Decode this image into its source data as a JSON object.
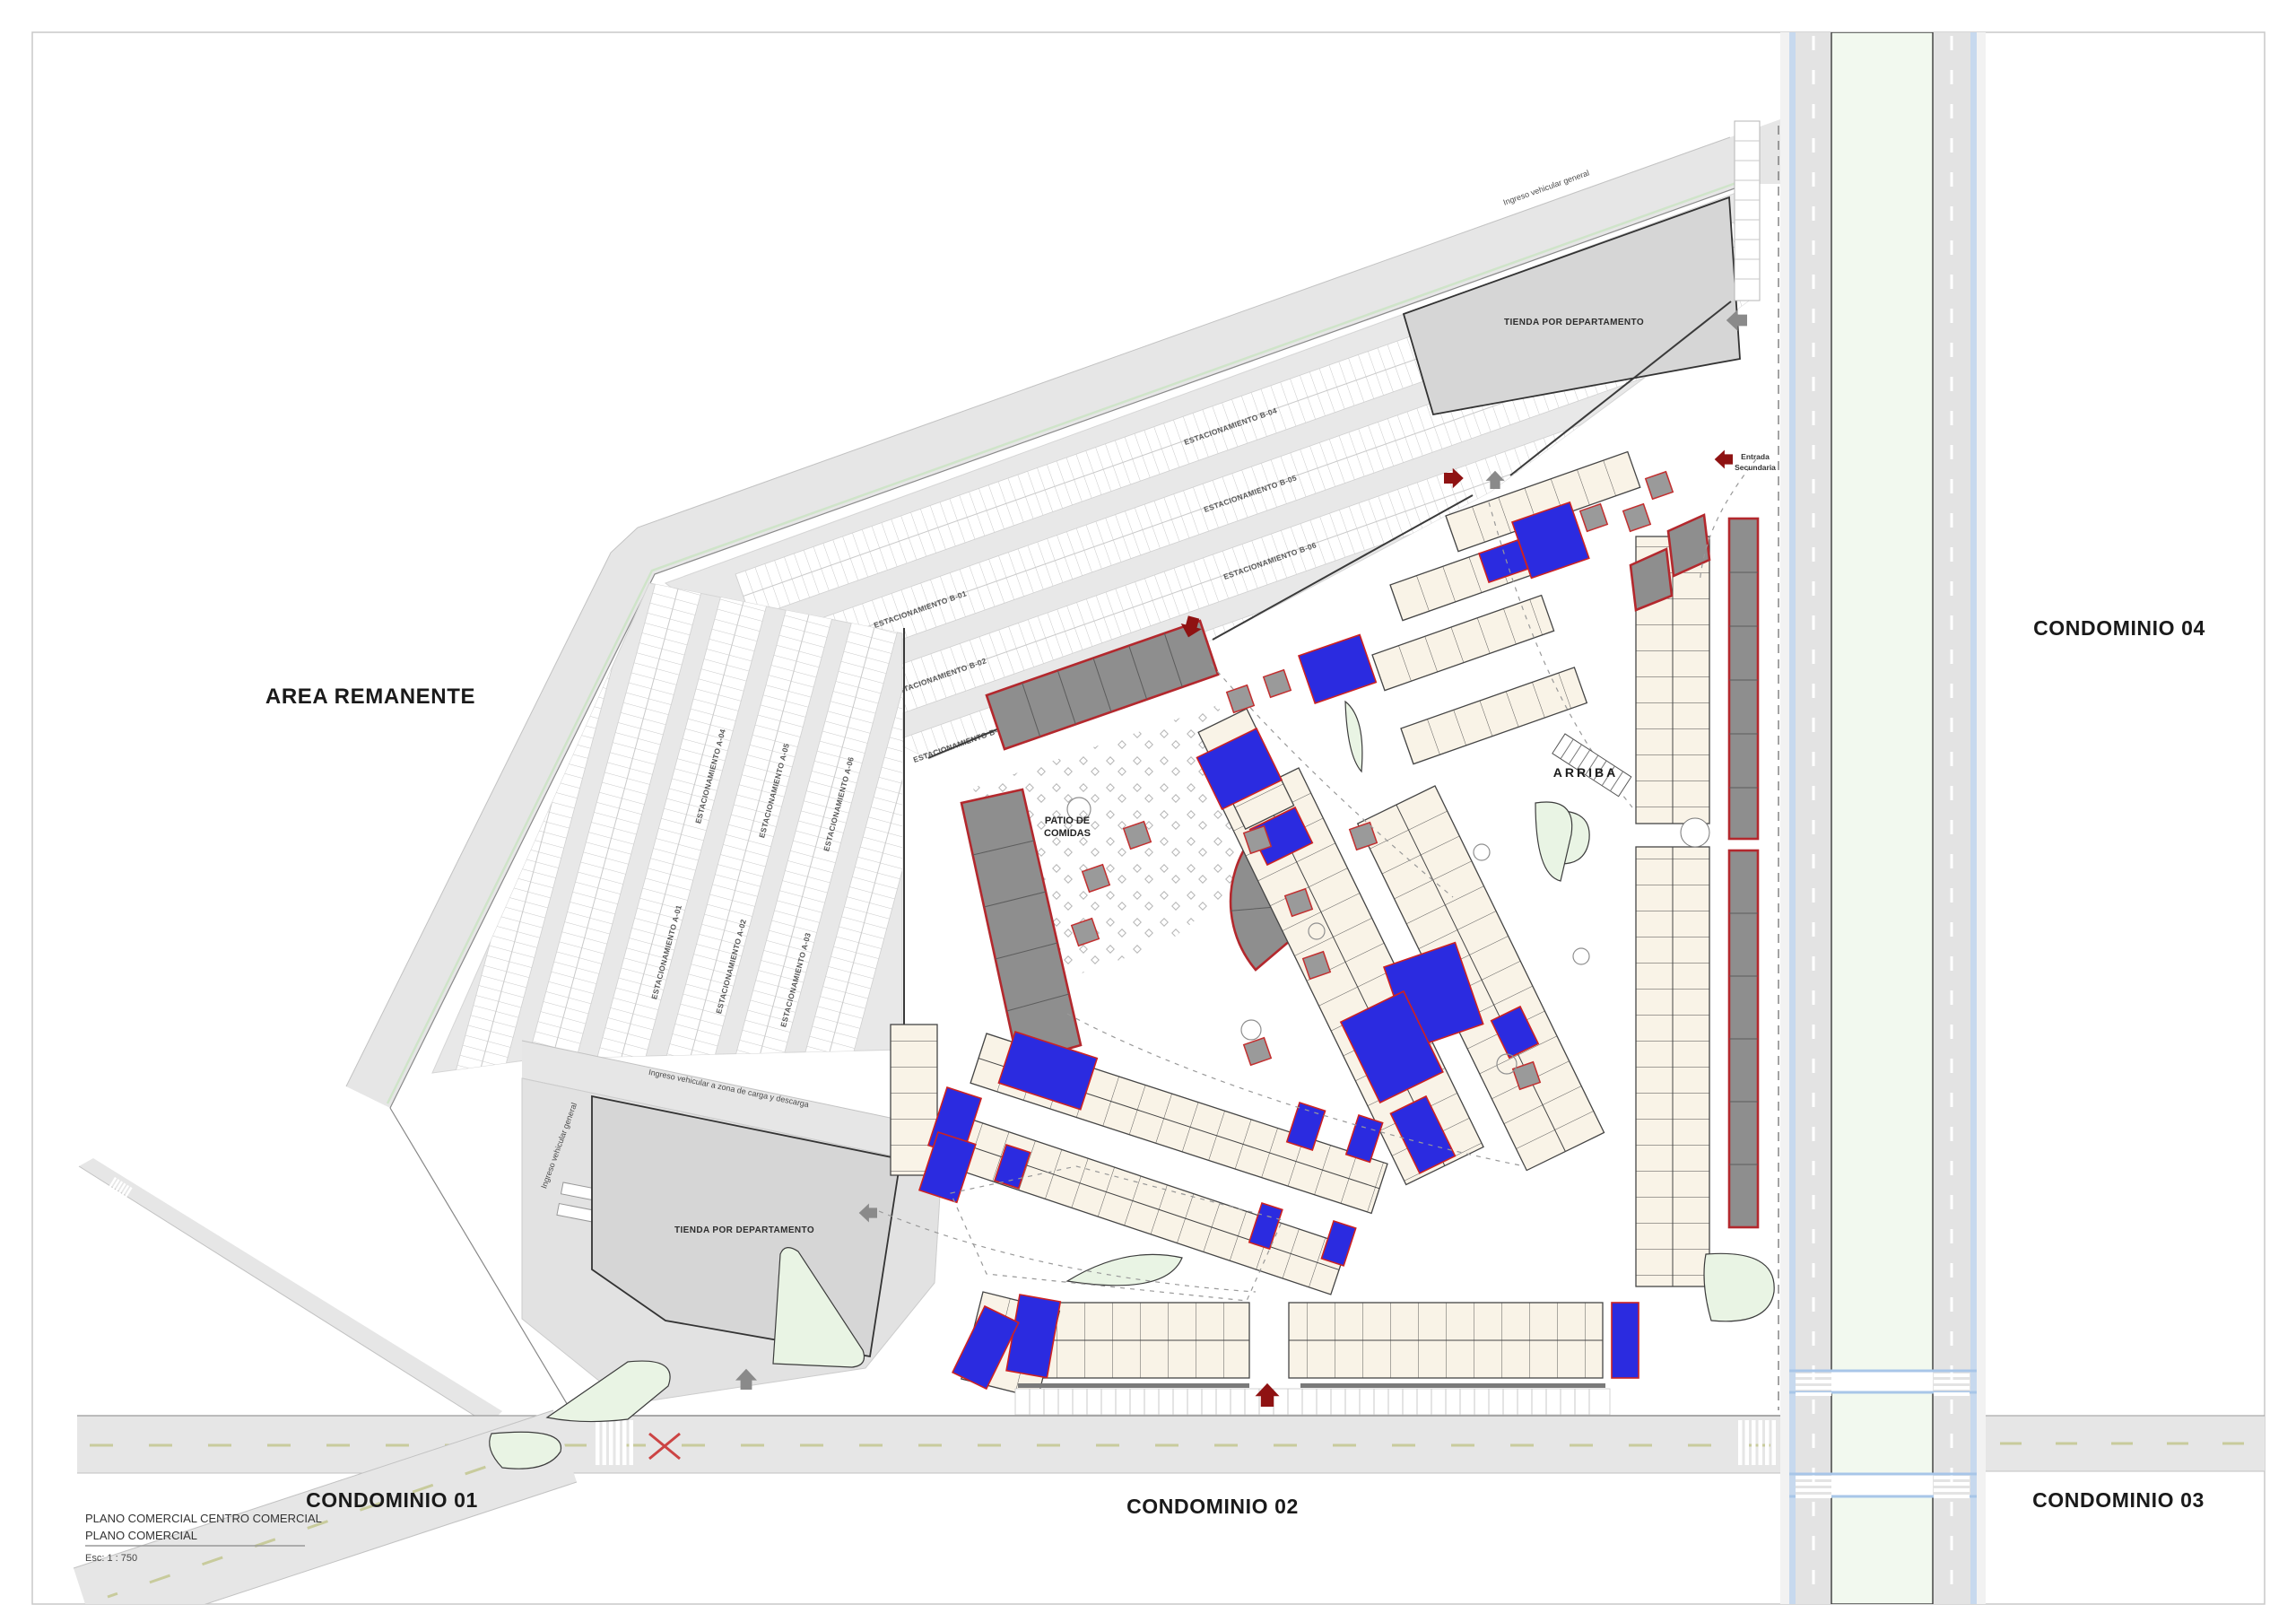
{
  "title_block": {
    "line1": "PLANO COMERCIAL CENTRO COMERCIAL",
    "line2": "PLANO COMERCIAL",
    "scale": "Esc: 1 : 750"
  },
  "areas": {
    "area_remanente": "AREA REMANENTE",
    "condominio_01": "CONDOMINIO 01",
    "condominio_02": "CONDOMINIO 02",
    "condominio_03": "CONDOMINIO 03",
    "condominio_04": "CONDOMINIO 04"
  },
  "buildings": {
    "department_store_north": "TIENDA POR DEPARTAMENTO",
    "department_store_south": "TIENDA POR DEPARTAMENTO",
    "food_court_line1": "PATIO DE",
    "food_court_line2": "COMIDAS",
    "stair_label": "ARRIBA"
  },
  "annotations": {
    "ingreso_general_top": "Ingreso vehicular general",
    "ingreso_general_west": "Ingreso vehicular general",
    "ingreso_carga": "Ingreso vehicular a zona de carga y descarga",
    "entrada_secundaria_line1": "Entrada",
    "entrada_secundaria_line2": "Secundaria"
  },
  "parking": {
    "rows_a": [
      "ESTACIONAMIENTO A-01",
      "ESTACIONAMIENTO A-02",
      "ESTACIONAMIENTO A-03",
      "ESTACIONAMIENTO A-04",
      "ESTACIONAMIENTO A-05",
      "ESTACIONAMIENTO A-06"
    ],
    "rows_b": [
      "ESTACIONAMIENTO B-01",
      "ESTACIONAMIENTO B-02",
      "ESTACIONAMIENTO B-03",
      "ESTACIONAMIENTO B-04",
      "ESTACIONAMIENTO B-05",
      "ESTACIONAMIENTO B-06"
    ]
  },
  "colors": {
    "unit_available": "#f9f3e7",
    "unit_reserved_blue": "#2b2be0",
    "anchor_gray": "#8e8e8e",
    "anchor_outline_red": "#b3282d",
    "entrance_arrow_red": "#8f1212",
    "road_gray": "#e6e6e6",
    "median_green": "#f2f9ef",
    "cycle_strip_blue": "#c7d9ee",
    "landscape_green": "#e9f4e4",
    "building_gray": "#d6d6d6"
  }
}
